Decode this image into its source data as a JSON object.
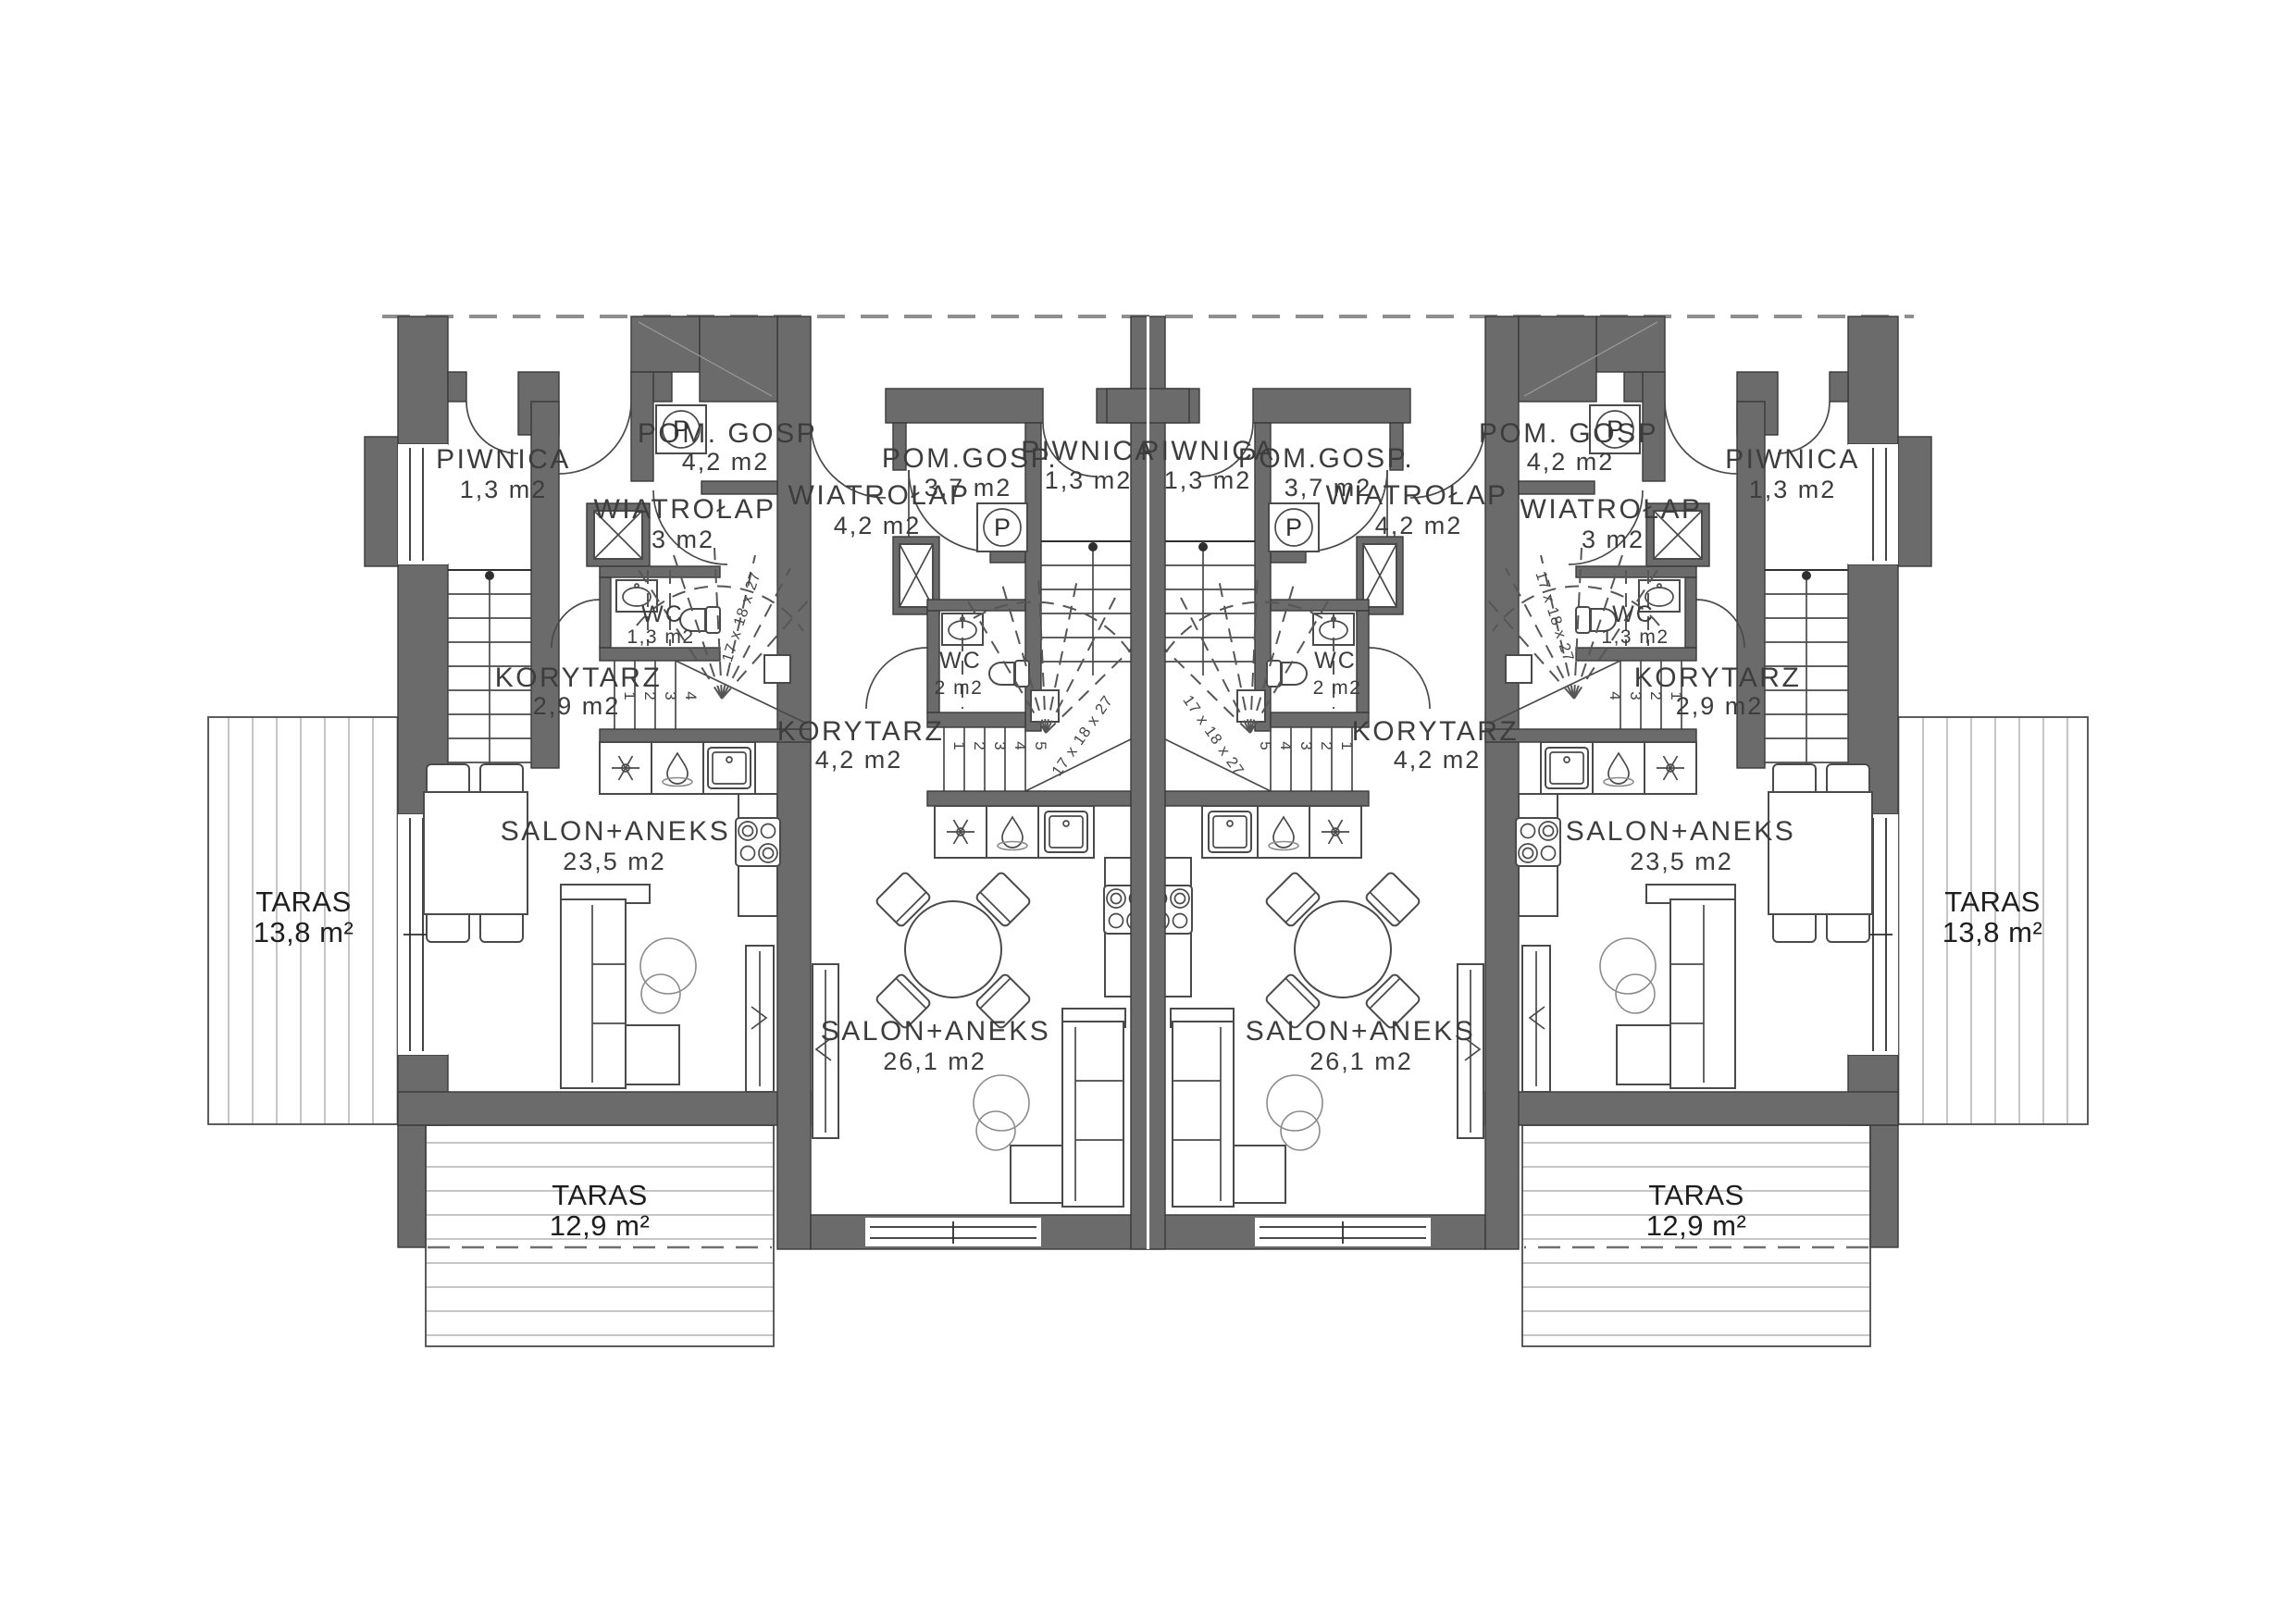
{
  "plan": {
    "wall_color": "#6b6b6b",
    "washer_label": "P",
    "stair_note": "17 x 18 x 27",
    "steps": [
      "1",
      "2",
      "3",
      "4",
      "5"
    ],
    "units": [
      {
        "id": "unit-1",
        "rooms": {
          "piwnica": {
            "name": "PIWNICA",
            "area": "1,3 m2"
          },
          "wiatrolap": {
            "name": "WIATROŁAP",
            "area": "3 m2"
          },
          "pomgosp": {
            "name": "POM. GOSP",
            "area": "4,2 m2"
          },
          "wc": {
            "name": "WC",
            "area": "1,3 m2"
          },
          "korytarz": {
            "name": "KORYTARZ",
            "area": "2,9 m2"
          },
          "salon": {
            "name": "SALON+ANEKS",
            "area": "23,5 m2"
          }
        }
      },
      {
        "id": "unit-2",
        "rooms": {
          "wiatrolap": {
            "name": "WIATROŁAP",
            "area": "4,2 m2"
          },
          "pomgosp": {
            "name": "POM.GOSP.",
            "area": "3,7 m2"
          },
          "piwnica": {
            "name": "PIWNICA",
            "area": "1,3 m2"
          },
          "wc": {
            "name": "WC",
            "area": "2 m2"
          },
          "korytarz": {
            "name": "KORYTARZ",
            "area": "4,2 m2"
          },
          "salon": {
            "name": "SALON+ANEKS",
            "area": "26,1 m2"
          }
        }
      },
      {
        "id": "unit-3",
        "rooms": {
          "wiatrolap": {
            "name": "WIATROŁAP",
            "area": "4,2 m2"
          },
          "pomgosp": {
            "name": "POM.GOSP.",
            "area": "3,7 m2"
          },
          "piwnica": {
            "name": "PIWNICA",
            "area": "1,3 m2"
          },
          "wc": {
            "name": "WC",
            "area": "2 m2"
          },
          "korytarz": {
            "name": "KORYTARZ",
            "area": "4,2 m2"
          },
          "salon": {
            "name": "SALON+ANEKS",
            "area": "26,1 m2"
          }
        }
      },
      {
        "id": "unit-4",
        "rooms": {
          "piwnica": {
            "name": "PIWNICA",
            "area": "1,3 m2"
          },
          "wiatrolap": {
            "name": "WIATROŁAP",
            "area": "3 m2"
          },
          "pomgosp": {
            "name": "POM. GOSP",
            "area": "4,2 m2"
          },
          "wc": {
            "name": "WC",
            "area": "1,3 m2"
          },
          "korytarz": {
            "name": "KORYTARZ",
            "area": "2,9 m2"
          },
          "salon": {
            "name": "SALON+ANEKS",
            "area": "23,5 m2"
          }
        }
      }
    ],
    "terraces": {
      "left": {
        "name": "TARAS",
        "area": "13,8 m²"
      },
      "right": {
        "name": "TARAS",
        "area": "13,8 m²"
      },
      "bottom_left": {
        "name": "TARAS",
        "area": "12,9 m²"
      },
      "bottom_right": {
        "name": "TARAS",
        "area": "12,9 m²"
      }
    }
  }
}
